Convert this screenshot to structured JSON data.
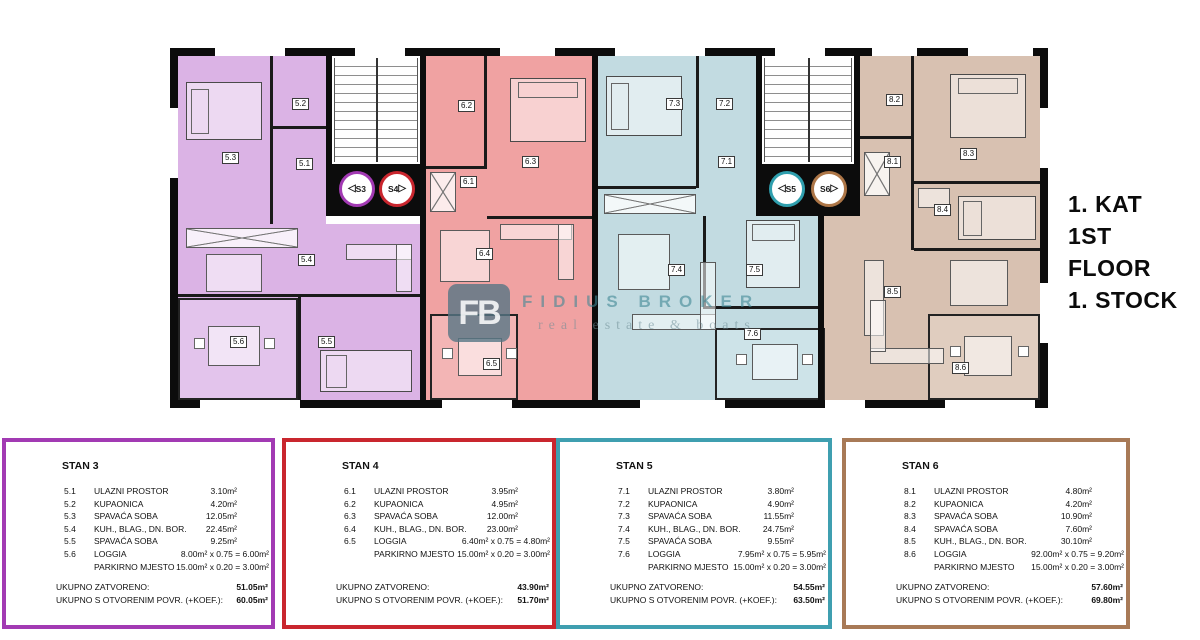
{
  "page": {
    "title_lines": [
      "1. KAT",
      "1ST FLOOR",
      "1. STOCK"
    ]
  },
  "watermark": {
    "logo_text": "FB",
    "brand": "FIDIUS BROKER",
    "tagline": "real estate & boats"
  },
  "colors": {
    "stan3_accent": "#a23ab3",
    "stan3_fill": "#dbb3e5",
    "stan4_accent": "#c9262e",
    "stan4_fill": "#f0a2a2",
    "stan5_accent": "#3f9fb0",
    "stan5_fill": "#c2dbe1",
    "stan6_accent": "#a87a57",
    "stan6_fill": "#d8c1b1",
    "walls": "#0c0c0c"
  },
  "plan": {
    "rooms": [
      {
        "label": "5.3",
        "x": 52,
        "y": 104
      },
      {
        "label": "5.2",
        "x": 122,
        "y": 50
      },
      {
        "label": "5.1",
        "x": 126,
        "y": 110
      },
      {
        "label": "5.4",
        "x": 128,
        "y": 206
      },
      {
        "label": "5.5",
        "x": 148,
        "y": 288
      },
      {
        "label": "5.6",
        "x": 60,
        "y": 288
      },
      {
        "label": "6.2",
        "x": 288,
        "y": 52
      },
      {
        "label": "6.1",
        "x": 290,
        "y": 128
      },
      {
        "label": "6.3",
        "x": 352,
        "y": 108
      },
      {
        "label": "6.4",
        "x": 306,
        "y": 200
      },
      {
        "label": "6.5",
        "x": 313,
        "y": 310
      },
      {
        "label": "7.3",
        "x": 496,
        "y": 50
      },
      {
        "label": "7.2",
        "x": 546,
        "y": 50
      },
      {
        "label": "7.1",
        "x": 548,
        "y": 108
      },
      {
        "label": "7.4",
        "x": 498,
        "y": 216
      },
      {
        "label": "7.5",
        "x": 576,
        "y": 216
      },
      {
        "label": "7.6",
        "x": 574,
        "y": 280
      },
      {
        "label": "8.2",
        "x": 716,
        "y": 46
      },
      {
        "label": "8.1",
        "x": 714,
        "y": 108
      },
      {
        "label": "8.3",
        "x": 790,
        "y": 100
      },
      {
        "label": "8.4",
        "x": 764,
        "y": 156
      },
      {
        "label": "8.5",
        "x": 714,
        "y": 238
      },
      {
        "label": "8.6",
        "x": 782,
        "y": 314
      }
    ],
    "badges": [
      {
        "label": "S3",
        "dir": "left",
        "color": "#a23ab3",
        "x": 169,
        "y": 123
      },
      {
        "label": "S4",
        "dir": "right",
        "color": "#c9262e",
        "x": 209,
        "y": 123
      },
      {
        "label": "S5",
        "dir": "left",
        "color": "#2f9fae",
        "x": 599,
        "y": 123
      },
      {
        "label": "S6",
        "dir": "right",
        "color": "#ad7647",
        "x": 641,
        "y": 123
      }
    ]
  },
  "apartments": [
    {
      "id": "stan3",
      "title": "STAN 3",
      "accent": "#a23ab3",
      "rows": [
        {
          "code": "5.1",
          "name": "ULAZNI PROSTOR",
          "value": "3.10m²"
        },
        {
          "code": "5.2",
          "name": "KUPAONICA",
          "value": "4.20m²"
        },
        {
          "code": "5.3",
          "name": "SPAVAĆA SOBA",
          "value": "12.05m²"
        },
        {
          "code": "5.4",
          "name": "KUH., BLAG., DN. BOR.",
          "value": "22.45m²"
        },
        {
          "code": "5.5",
          "name": "SPAVAĆA SOBA",
          "value": "9.25m²"
        },
        {
          "code": "5.6",
          "name": "LOGGIA",
          "value": "8.00m² x 0.75 = 6.00m²"
        },
        {
          "code": "",
          "name": "PARKIRNO MJESTO",
          "value": "15.00m² x 0.20 = 3.00m²"
        }
      ],
      "totals": [
        {
          "label": "UKUPNO ZATVORENO:",
          "value": "51.05m²"
        },
        {
          "label": "UKUPNO S OTVORENIM POVR. (+KOEF.):",
          "value": "60.05m²"
        }
      ]
    },
    {
      "id": "stan4",
      "title": "STAN 4",
      "accent": "#c9262e",
      "rows": [
        {
          "code": "6.1",
          "name": "ULAZNI PROSTOR",
          "value": "3.95m²"
        },
        {
          "code": "6.2",
          "name": "KUPAONICA",
          "value": "4.95m²"
        },
        {
          "code": "6.3",
          "name": "SPAVAĆA SOBA",
          "value": "12.00m²"
        },
        {
          "code": "6.4",
          "name": "KUH., BLAG., DN. BOR.",
          "value": "23.00m²"
        },
        {
          "code": "6.5",
          "name": "LOGGIA",
          "value": "6.40m² x 0.75 = 4.80m²"
        },
        {
          "code": "",
          "name": "PARKIRNO MJESTO",
          "value": "15.00m² x 0.20 = 3.00m²"
        }
      ],
      "totals": [
        {
          "label": "UKUPNO ZATVORENO:",
          "value": "43.90m²"
        },
        {
          "label": "UKUPNO S OTVORENIM POVR. (+KOEF.):",
          "value": "51.70m²"
        }
      ]
    },
    {
      "id": "stan5",
      "title": "STAN 5",
      "accent": "#3f9fb0",
      "rows": [
        {
          "code": "7.1",
          "name": "ULAZNI PROSTOR",
          "value": "3.80m²"
        },
        {
          "code": "7.2",
          "name": "KUPAONICA",
          "value": "4.90m²"
        },
        {
          "code": "7.3",
          "name": "SPAVAĆA SOBA",
          "value": "11.55m²"
        },
        {
          "code": "7.4",
          "name": "KUH., BLAG., DN. BOR.",
          "value": "24.75m²"
        },
        {
          "code": "7.5",
          "name": "SPAVAĆA SOBA",
          "value": "9.55m²"
        },
        {
          "code": "7.6",
          "name": "LOGGIA",
          "value": "7.95m² x 0.75 = 5.95m²"
        },
        {
          "code": "",
          "name": "PARKIRNO MJESTO",
          "value": "15.00m² x 0.20 = 3.00m²"
        }
      ],
      "totals": [
        {
          "label": "UKUPNO ZATVORENO:",
          "value": "54.55m²"
        },
        {
          "label": "UKUPNO S OTVORENIM POVR. (+KOEF.):",
          "value": "63.50m²"
        }
      ]
    },
    {
      "id": "stan6",
      "title": "STAN 6",
      "accent": "#a87a57",
      "rows": [
        {
          "code": "8.1",
          "name": "ULAZNI PROSTOR",
          "value": "4.80m²"
        },
        {
          "code": "8.2",
          "name": "KUPAONICA",
          "value": "4.20m²"
        },
        {
          "code": "8.3",
          "name": "SPAVAĆA SOBA",
          "value": "10.90m²"
        },
        {
          "code": "8.4",
          "name": "SPAVAĆA SOBA",
          "value": "7.60m²"
        },
        {
          "code": "8.5",
          "name": "KUH., BLAG., DN. BOR.",
          "value": "30.10m²"
        },
        {
          "code": "8.6",
          "name": "LOGGIA",
          "value": "92.00m² x 0.75 = 9.20m²"
        },
        {
          "code": "",
          "name": "PARKIRNO MJESTO",
          "value": "15.00m² x 0.20 = 3.00m²"
        }
      ],
      "totals": [
        {
          "label": "UKUPNO ZATVORENO:",
          "value": "57.60m²"
        },
        {
          "label": "UKUPNO S OTVORENIM POVR. (+KOEF.):",
          "value": "69.80m²"
        }
      ]
    }
  ]
}
